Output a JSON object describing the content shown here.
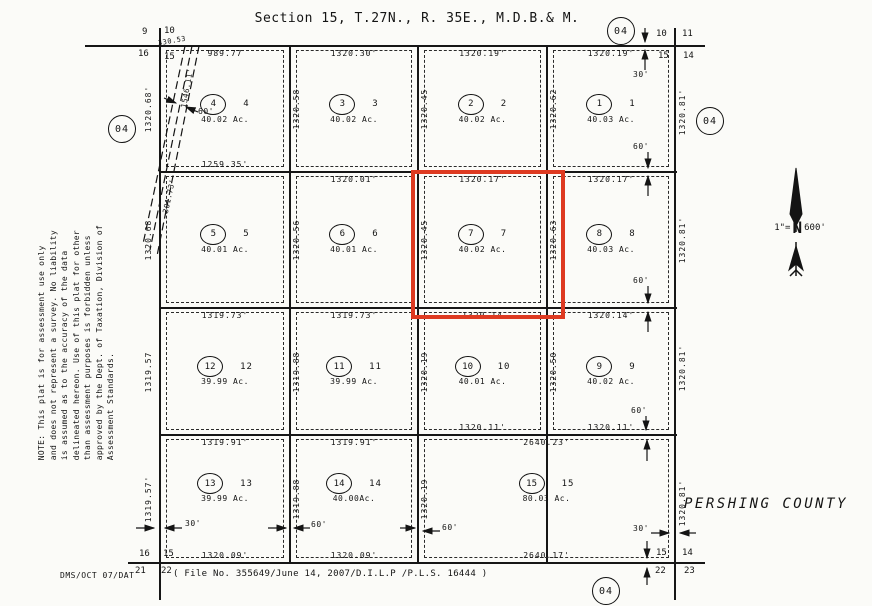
{
  "title": "Section 15, T.27N., R. 35E., M.D.B.& M.",
  "county_label": "PERSHING COUNTY",
  "scale": {
    "prefix": "1\"=",
    "north": "N",
    "value": "600'"
  },
  "ref_circle": "04",
  "footer": {
    "left": "DMS/OCT 07/DAT",
    "file_note": "( File No. 355649/June 14, 2007/D.I.L.P /P.L.S. 16444 )"
  },
  "note_lines": [
    "NOTE:  This plat is for assessment use only",
    "and does not represent a survey.  No liability",
    "is assumed as to the accuracy of the data",
    "delineated hereon.  Use of this plat for other",
    "than assessment purposes is forbidden unless",
    "approved by the Dept. of Taxation, Division of",
    "Assessment Standards."
  ],
  "widths": {
    "w30": "30'",
    "w60": "60'"
  },
  "corners": {
    "tl": [
      "9",
      "10",
      "16",
      "15"
    ],
    "tr": [
      "10",
      "11",
      "15",
      "14"
    ],
    "bl": [
      "16",
      "15",
      "21",
      "22"
    ],
    "br": [
      "15",
      "14",
      "22",
      "23"
    ]
  },
  "colors": {
    "highlight": "#de3a21",
    "ink": "#161616"
  },
  "parcels": [
    {
      "num": "1",
      "acres": "40.03 Ac.",
      "top": "1320.19'",
      "left_len": "1320.62",
      "right_len": "1320.81'"
    },
    {
      "num": "2",
      "acres": "40.02 Ac.",
      "top": "1320.19'",
      "left_len": "1320.45"
    },
    {
      "num": "3",
      "acres": "40.02 Ac.",
      "top": "1320.30'",
      "left_len": "1320.58"
    },
    {
      "num": "4",
      "acres": "40.02 Ac.",
      "top": "989.77",
      "left_len": "1320.68'",
      "bottom": "1259.35'",
      "diagonal_len": "1546.11'",
      "corner_len": "330.53"
    },
    {
      "num": "5",
      "acres": "40.01 Ac.",
      "left_len": "1320.68",
      "diagonal_len": "301.73'"
    },
    {
      "num": "6",
      "acres": "40.01 Ac.",
      "top": "1320.01'",
      "left_len": "1320.56"
    },
    {
      "num": "7",
      "acres": "40.02 Ac.",
      "top": "1320.17'",
      "left_len": "1320.45",
      "highlighted": true
    },
    {
      "num": "8",
      "acres": "40.03 Ac.",
      "top": "1320.17'",
      "left_len": "1320.63",
      "right_len": "1320.81'"
    },
    {
      "num": "9",
      "acres": "40.02 Ac.",
      "top": "1320.14'",
      "left_len": "1320.50",
      "right_len": "1320.81'",
      "bottom": "1320.11'"
    },
    {
      "num": "10",
      "acres": "40.01 Ac.",
      "top": "1320.14",
      "left_len": "1320.19",
      "bottom": "1320.11'"
    },
    {
      "num": "11",
      "acres": "39.99 Ac.",
      "top": "1319.73'",
      "left_len": "1319.88"
    },
    {
      "num": "12",
      "acres": "39.99 Ac.",
      "top": "1319.73'",
      "left_len": "1319.57"
    },
    {
      "num": "13",
      "acres": "39.99 Ac.",
      "top": "1319.91'",
      "left_len": "1319.57'",
      "bottom": "1320.09'"
    },
    {
      "num": "14",
      "acres": "40.00Ac.",
      "top": "1319.91'",
      "left_len": "1319.88",
      "bottom": "1320.09'"
    },
    {
      "num": "15",
      "acres": "80.03 Ac.",
      "top": "2640.23'",
      "left_len": "1320.19",
      "right_len": "1320.81'",
      "bottom": "2640.17'"
    }
  ]
}
